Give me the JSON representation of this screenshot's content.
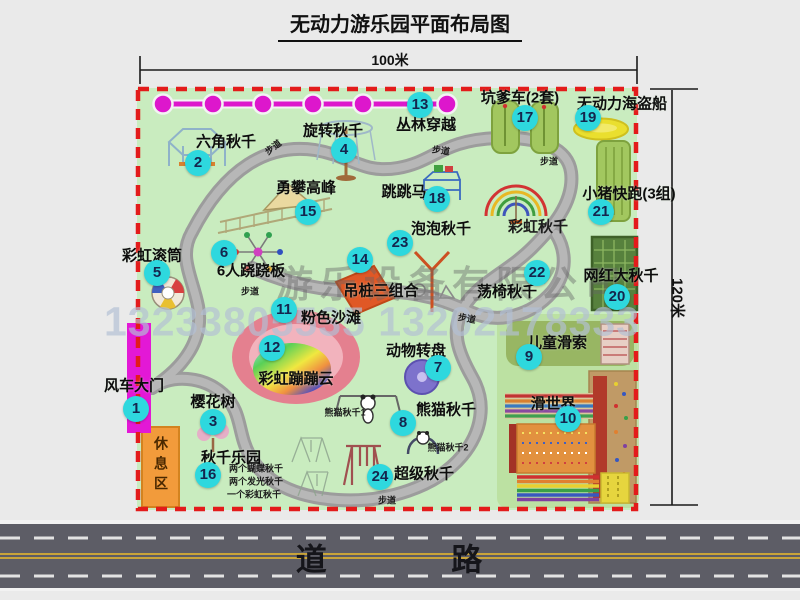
{
  "title": "无动力游乐园平面布局图",
  "dimensions": {
    "top": "100米",
    "right": "120米"
  },
  "road": {
    "label": "道 路"
  },
  "watermark": {
    "company": "游乐设备有限公司",
    "phone": "13233805535 13202178333"
  },
  "colors": {
    "map_green": "#c9ecbf",
    "border_red": "#e31b1b",
    "circle_cyan": "#2ed8de",
    "zipline_magenta": "#dd17cc",
    "gate_magenta": "#e318d6",
    "rest_orange": "#f29b3b",
    "path_gray": "#9e9e9e",
    "road_gray": "#5d5d66"
  },
  "attractions": [
    {
      "n": 1,
      "label": "风车大门",
      "label_x": 134,
      "label_y": 385,
      "circle_x": 136,
      "circle_y": 409
    },
    {
      "n": 2,
      "label": "六角秋千",
      "label_x": 226,
      "label_y": 141,
      "circle_x": 198,
      "circle_y": 163
    },
    {
      "n": 3,
      "label": "樱花树",
      "label_x": 213,
      "label_y": 401,
      "circle_x": 213,
      "circle_y": 422
    },
    {
      "n": 4,
      "label": "旋转秋千",
      "label_x": 333,
      "label_y": 130,
      "circle_x": 344,
      "circle_y": 150
    },
    {
      "n": 5,
      "label": "彩虹滚筒",
      "label_x": 152,
      "label_y": 255,
      "circle_x": 157,
      "circle_y": 273
    },
    {
      "n": 6,
      "label": "6人跷跷板",
      "label_x": 251,
      "label_y": 270,
      "circle_x": 224,
      "circle_y": 253
    },
    {
      "n": 7,
      "label": "动物转盘",
      "label_x": 416,
      "label_y": 350,
      "circle_x": 438,
      "circle_y": 368
    },
    {
      "n": 8,
      "label": "熊猫秋千",
      "label_x": 446,
      "label_y": 409,
      "circle_x": 403,
      "circle_y": 423
    },
    {
      "n": 9,
      "label": "儿童滑索",
      "label_x": 557,
      "label_y": 342,
      "circle_x": 529,
      "circle_y": 357
    },
    {
      "n": 10,
      "label": "滑世界",
      "label_x": 553,
      "label_y": 403,
      "circle_x": 568,
      "circle_y": 419
    },
    {
      "n": 11,
      "label": "粉色沙滩",
      "label_x": 331,
      "label_y": 317,
      "circle_x": 284,
      "circle_y": 310
    },
    {
      "n": 12,
      "label": "彩虹蹦蹦云",
      "label_x": 296,
      "label_y": 378,
      "circle_x": 272,
      "circle_y": 348
    },
    {
      "n": 13,
      "label": "丛林穿越",
      "label_x": 426,
      "label_y": 124,
      "circle_x": 420,
      "circle_y": 105
    },
    {
      "n": 14,
      "label": "吊桩三组合",
      "label_x": 381,
      "label_y": 290,
      "circle_x": 360,
      "circle_y": 260
    },
    {
      "n": 15,
      "label": "勇攀高峰",
      "label_x": 306,
      "label_y": 187,
      "circle_x": 308,
      "circle_y": 212
    },
    {
      "n": 16,
      "label": "秋千乐园",
      "label_x": 231,
      "label_y": 457,
      "circle_x": 208,
      "circle_y": 475
    },
    {
      "n": 17,
      "label": "坑爹车(2套)",
      "label_x": 520,
      "label_y": 97,
      "circle_x": 525,
      "circle_y": 118
    },
    {
      "n": 18,
      "label": "跳跳马",
      "label_x": 404,
      "label_y": 191,
      "circle_x": 437,
      "circle_y": 199
    },
    {
      "n": 19,
      "label": "无动力海盗船",
      "label_x": 622,
      "label_y": 103,
      "circle_x": 588,
      "circle_y": 118
    },
    {
      "n": 20,
      "label": "网红大秋千",
      "label_x": 621,
      "label_y": 275,
      "circle_x": 617,
      "circle_y": 297
    },
    {
      "n": 21,
      "label": "小猪快跑(3组)",
      "label_x": 629,
      "label_y": 193,
      "circle_x": 601,
      "circle_y": 212
    },
    {
      "n": 22,
      "label": "荡椅秋千",
      "label_x": 507,
      "label_y": 291,
      "circle_x": 537,
      "circle_y": 273
    },
    {
      "n": 23,
      "label": "泡泡秋千",
      "label_x": 441,
      "label_y": 228,
      "circle_x": 400,
      "circle_y": 243
    },
    {
      "n": 24,
      "label": "超级秋千",
      "label_x": 424,
      "label_y": 473,
      "circle_x": 380,
      "circle_y": 477
    }
  ],
  "free_labels": [
    {
      "text": "彩虹秋千",
      "x": 538,
      "y": 226,
      "size": 15,
      "bold": true
    },
    {
      "text": "休息区",
      "x": 161,
      "y": 466,
      "size": 14,
      "bold": true,
      "vertical": true
    },
    {
      "text": "熊猫秋千1",
      "x": 345,
      "y": 412,
      "size": 9,
      "bold": true
    },
    {
      "text": "熊猫秋千2",
      "x": 448,
      "y": 447,
      "size": 9,
      "bold": true
    },
    {
      "text": "两个蝴蝶秋千",
      "x": 256,
      "y": 468,
      "size": 9,
      "bold": true
    },
    {
      "text": "两个发光秋千",
      "x": 256,
      "y": 481,
      "size": 9,
      "bold": true
    },
    {
      "text": "一个彩虹秋千",
      "x": 254,
      "y": 494,
      "size": 9,
      "bold": true
    },
    {
      "text": "步道",
      "x": 273,
      "y": 147,
      "size": 9,
      "rot": -38,
      "bold": true
    },
    {
      "text": "步道",
      "x": 441,
      "y": 150,
      "size": 9,
      "rot": 8,
      "bold": true
    },
    {
      "text": "步道",
      "x": 549,
      "y": 161,
      "size": 9,
      "rot": 0,
      "bold": true
    },
    {
      "text": "步道",
      "x": 250,
      "y": 291,
      "size": 9,
      "rot": 0,
      "bold": true
    },
    {
      "text": "步道",
      "x": 467,
      "y": 318,
      "size": 9,
      "rot": 10,
      "bold": true
    },
    {
      "text": "步道",
      "x": 387,
      "y": 500,
      "size": 9,
      "rot": 0,
      "bold": true
    }
  ]
}
